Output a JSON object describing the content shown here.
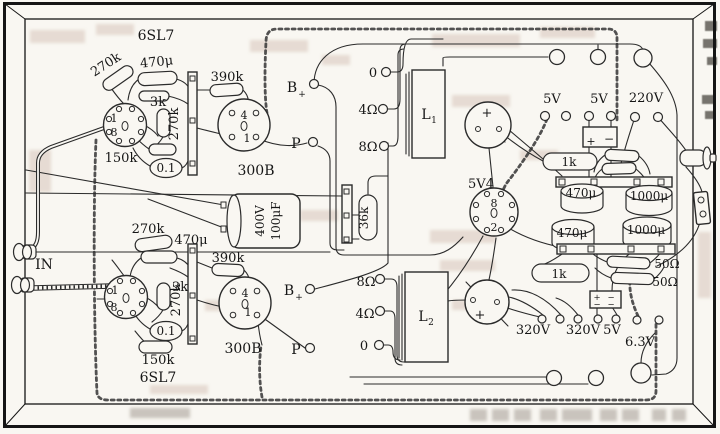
{
  "input": {
    "label": "IN"
  },
  "top_channel": {
    "tube": "6SL7",
    "r1": "270k",
    "c1": "470μ",
    "r2": "3k",
    "r3": "270k",
    "r4": "150k",
    "c2": "0.1",
    "r5": "390k",
    "pin1": "1",
    "pin8": "8"
  },
  "top_300b": {
    "tube": "300B",
    "pin4": "4",
    "pin1": "1",
    "b": "B",
    "b_plus": "+",
    "p": "P"
  },
  "top_output": {
    "tap0": "0",
    "tap4": "4Ω",
    "tap8": "8Ω",
    "name": "L",
    "sub": "1"
  },
  "bottom_channel": {
    "tube": "6SL7",
    "r1": "270k",
    "c1": "470μ",
    "r2": "3k",
    "r3": "270k",
    "r4": "150k",
    "c2": "0.1",
    "r5": "390k",
    "pin1": "1",
    "pin8": "8"
  },
  "bottom_300b": {
    "tube": "300B",
    "pin4": "4",
    "pin1": "1",
    "b": "B",
    "b_plus": "+",
    "p": "P"
  },
  "bottom_output": {
    "tap8": "8Ω",
    "tap4": "4Ω",
    "tap0": "0",
    "name": "L",
    "sub": "2"
  },
  "center": {
    "cap_v": "400V",
    "cap_c": "100μF",
    "r36k": "36k"
  },
  "rectifier": {
    "tube": "5V4",
    "pin8": "8",
    "pin2": "2",
    "can1_plus": "+",
    "can2_plus": "+"
  },
  "power": {
    "v5a": "5V",
    "v5b": "5V",
    "v220": "220V",
    "blk1_plus": "+",
    "blk1_minus": "−",
    "r1k_a": "1k",
    "c470a": "470μ",
    "c1000a": "1000μ",
    "c470b": "470μ",
    "c1000b": "1000μ",
    "r1k_b": "1k",
    "r50a": "50Ω",
    "r50b": "50Ω",
    "blk2_p1": "+",
    "blk2_m1": "−",
    "blk2_m2": "−",
    "blk2_m3": "−",
    "v320a": "320V",
    "v320b": "320V",
    "v5c": "5V",
    "v63": "6.3V"
  }
}
